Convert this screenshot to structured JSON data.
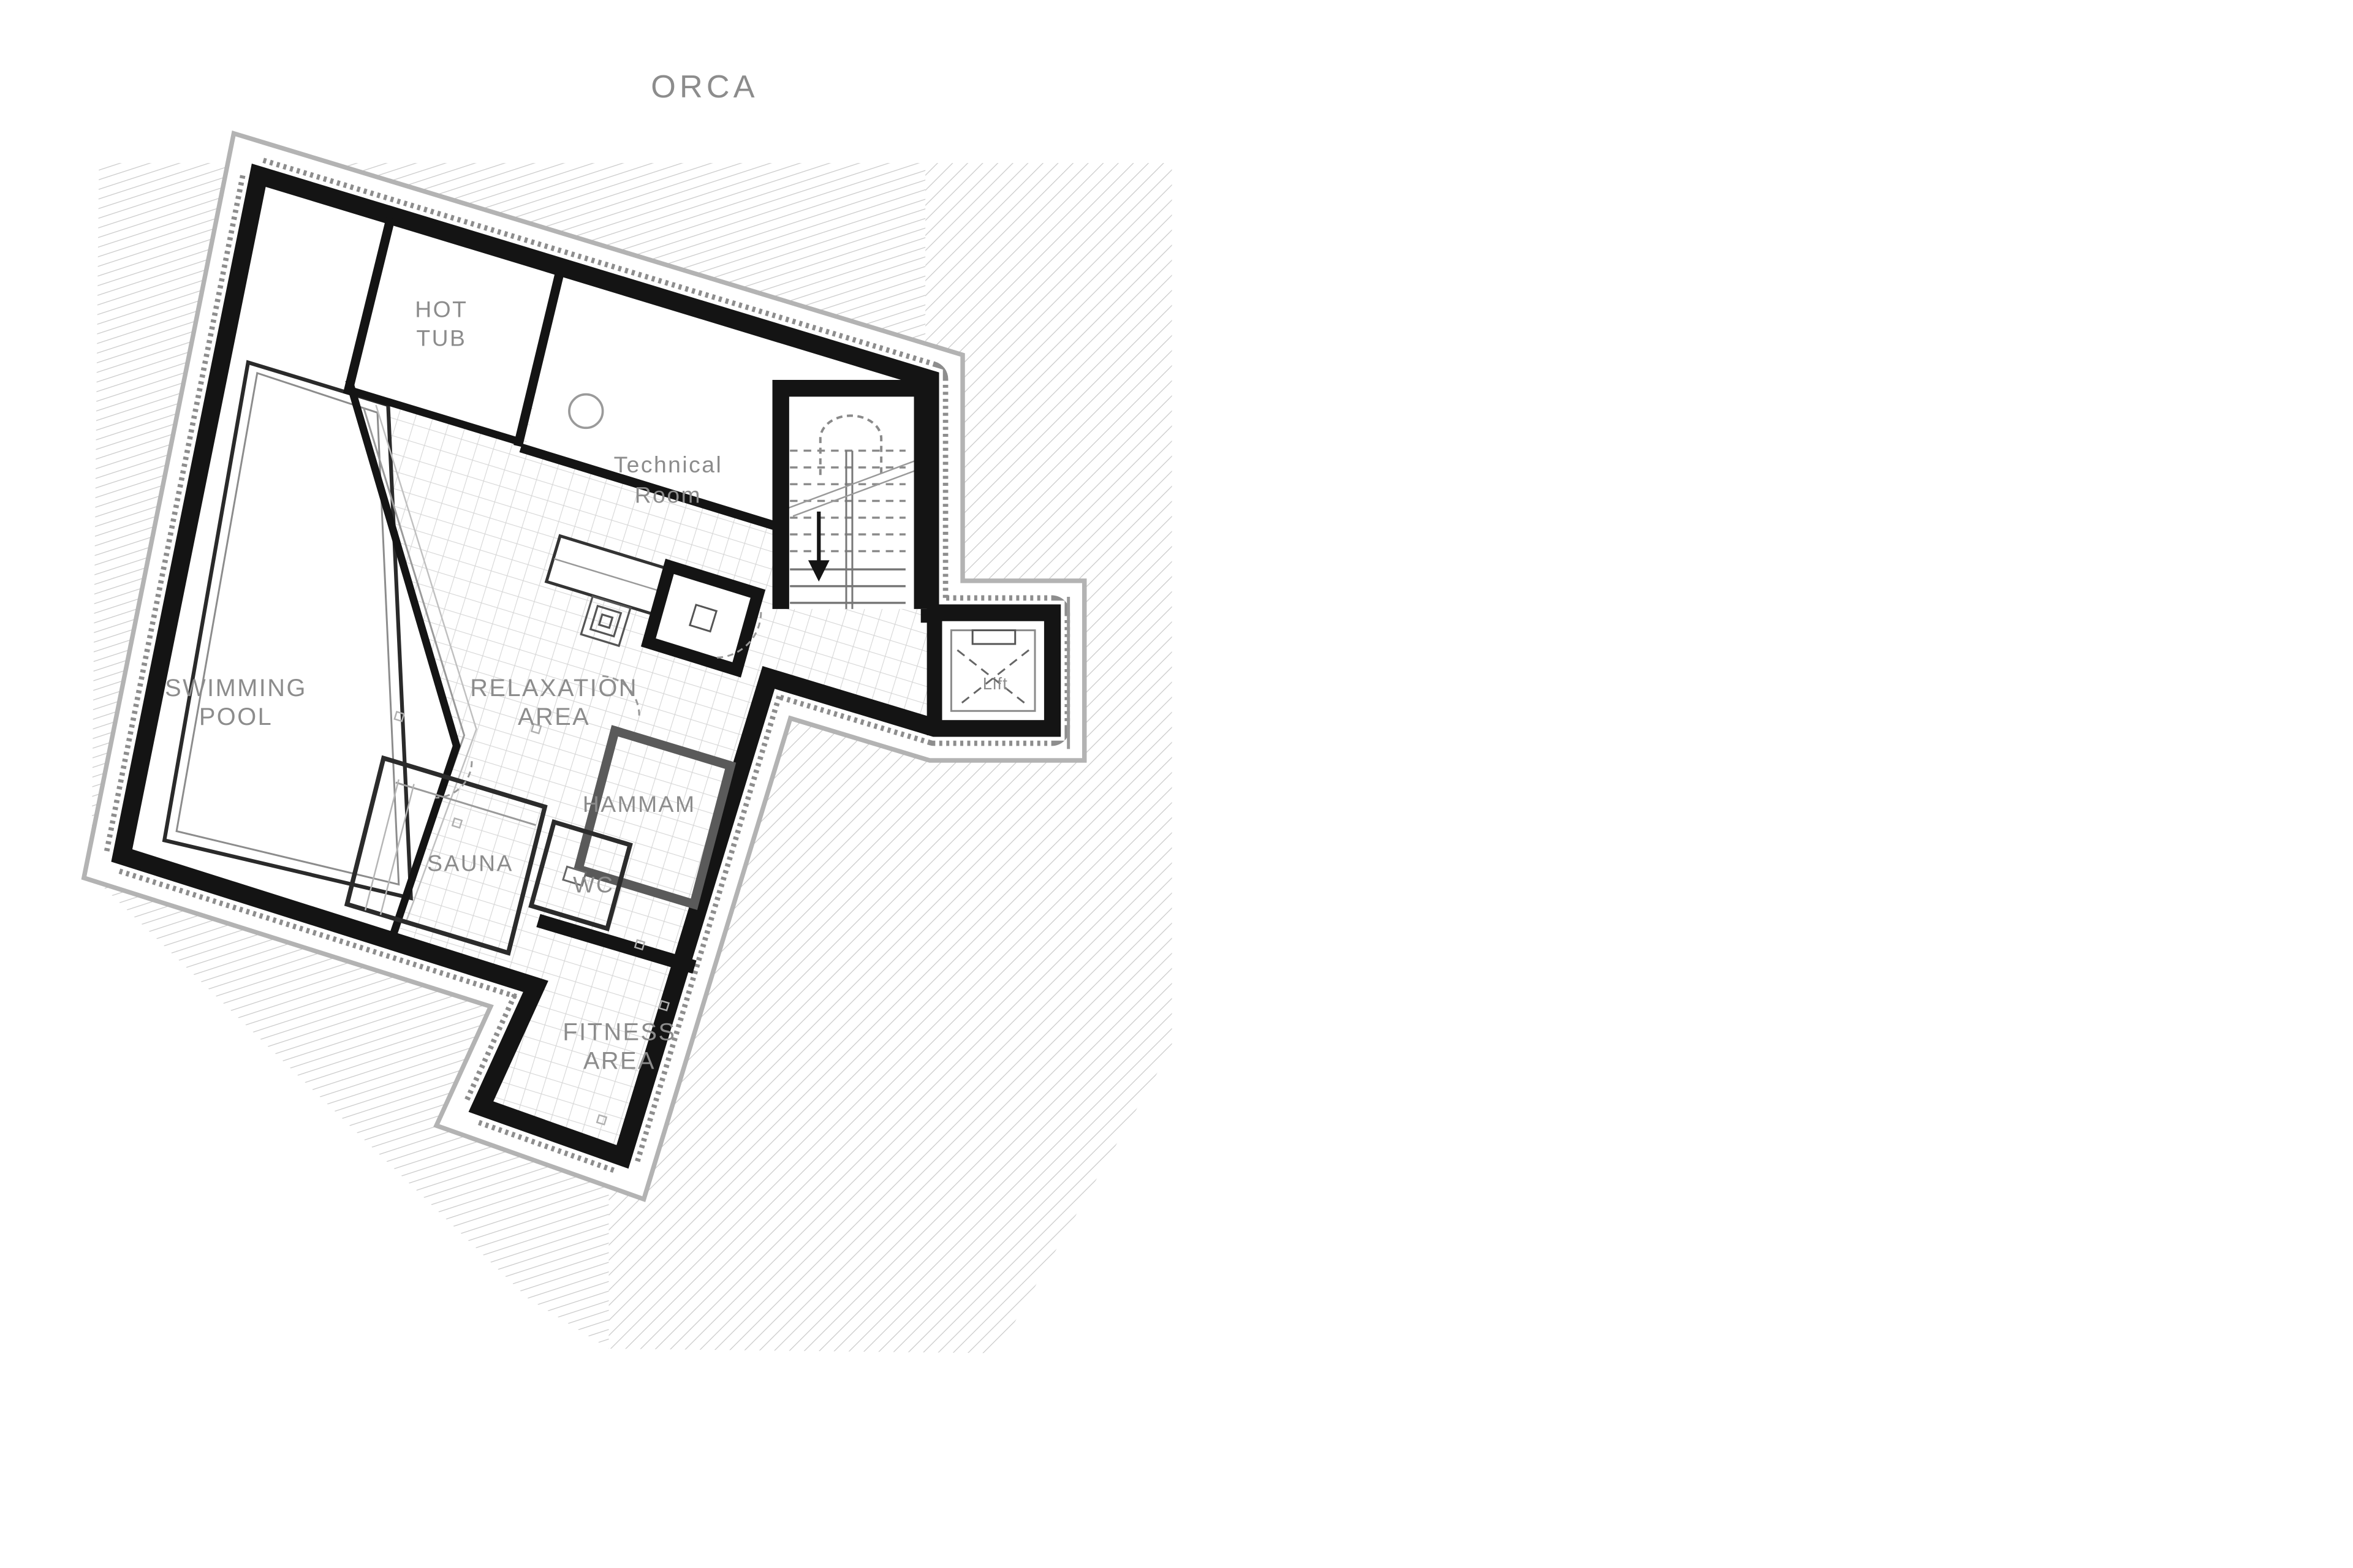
{
  "title": "ORCA",
  "plan": {
    "rooms": [
      {
        "id": "hot-tub",
        "lines": [
          "HOT",
          "TUB"
        ]
      },
      {
        "id": "technical-room",
        "lines": [
          "Technical",
          "Room"
        ]
      },
      {
        "id": "swimming-pool",
        "lines": [
          "SWIMMING",
          "POOL"
        ]
      },
      {
        "id": "relaxation-area",
        "lines": [
          "RELAXATION",
          "AREA"
        ]
      },
      {
        "id": "hammam",
        "lines": [
          "HAMMAM"
        ]
      },
      {
        "id": "sauna",
        "lines": [
          "SAUNA"
        ]
      },
      {
        "id": "wc",
        "lines": [
          "WC"
        ]
      },
      {
        "id": "fitness-area",
        "lines": [
          "FITNESS",
          "AREA"
        ]
      },
      {
        "id": "lift",
        "lines": [
          "Lift"
        ]
      }
    ],
    "icons": {
      "stair_direction": "down-arrow-icon",
      "lift_shaft": "crossed-square-icon"
    },
    "colors": {
      "wall": "#141414",
      "label": "#8c8c8c",
      "title": "#8c8c8c",
      "hatch": "#c9c9c9",
      "grid": "#d6d6d6",
      "insulation": "#8d8d8d"
    }
  }
}
